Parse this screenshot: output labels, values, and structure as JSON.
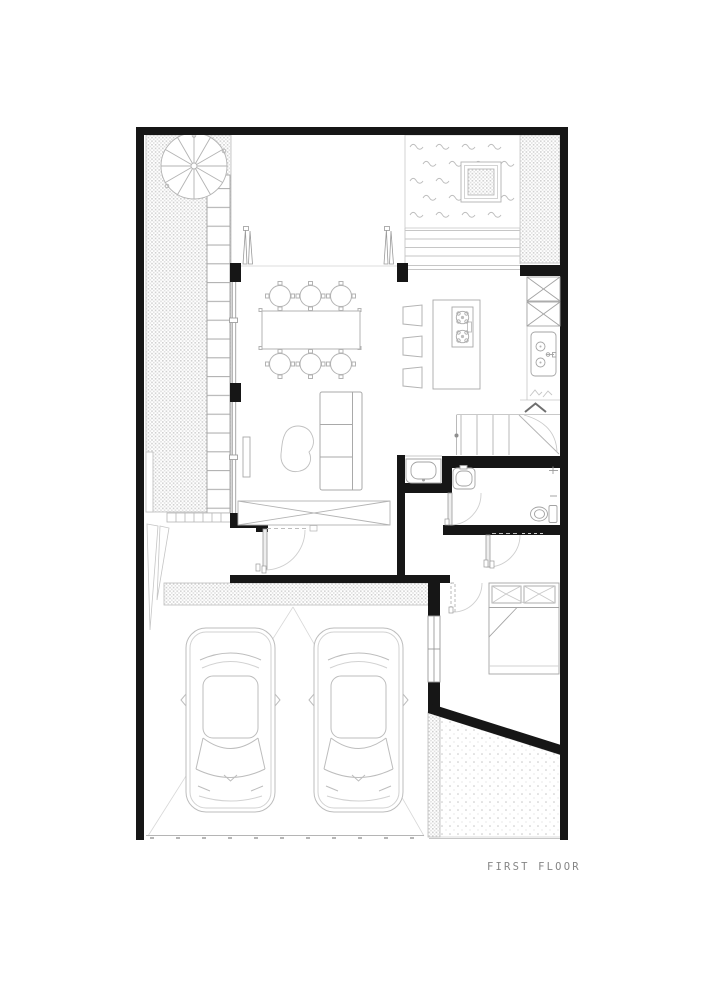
{
  "page": {
    "background": "#ffffff"
  },
  "plan": {
    "label": "FIRST FLOOR",
    "colors": {
      "wall": "#161616",
      "paper": "#ffffff",
      "line_strong": "#9e9e9e",
      "line_light": "#c9c9c9",
      "stipple": "#d2d2d2",
      "dots": "#c6c6c6",
      "label_text": "#868686"
    },
    "features": [
      "spiral-staircase",
      "planter-strip",
      "green-wall-ladder",
      "reflecting-pool",
      "pool-planter",
      "pool-steps",
      "patio",
      "pivot-doors",
      "dining-table",
      "dining-chairs-x6",
      "bar-stools-x3",
      "kitchen-island-cooktop",
      "tall-cabinets",
      "kitchen-sink",
      "staircase-up",
      "understair-washbasin",
      "powder-room",
      "toilet",
      "hall",
      "entry-door",
      "bedroom",
      "double-bed",
      "bedroom-window",
      "garage",
      "cars-x2",
      "garage-apron",
      "driveway-ramp",
      "garden-patch"
    ]
  }
}
